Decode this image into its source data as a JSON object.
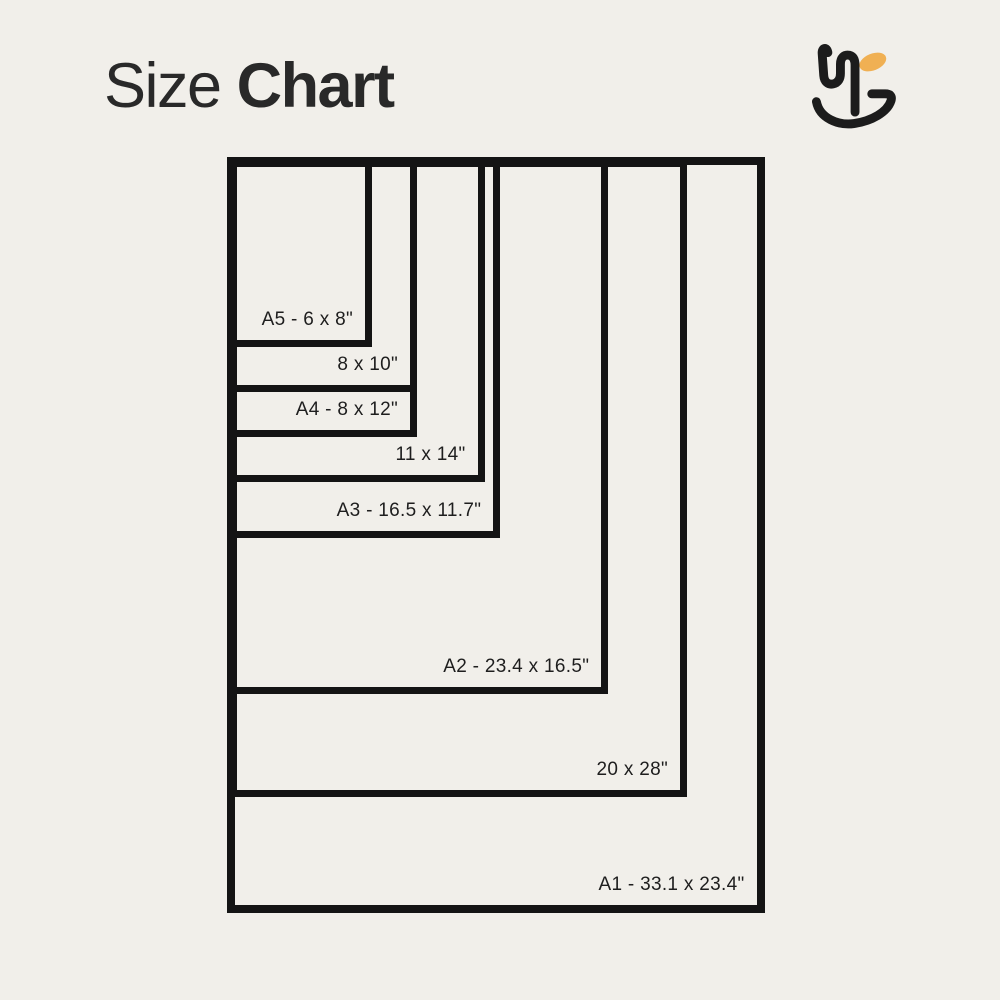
{
  "page": {
    "background_color": "#f1efea"
  },
  "header": {
    "title_regular": "Size",
    "title_bold": "Chart",
    "title_color": "#292929"
  },
  "logo": {
    "ink_color": "#1c1c1c",
    "accent_color": "#f0b053"
  },
  "chart": {
    "type": "nested-size-diagram",
    "units": "inches",
    "line_color": "#141414",
    "sizes": [
      {
        "name": "A1",
        "label": "A1 - 33.1 x 23.4\"",
        "width_in": 23.4,
        "height_in": 33.1
      },
      {
        "name": "20x28",
        "label": "20 x 28\"",
        "width_in": 20,
        "height_in": 28
      },
      {
        "name": "A2",
        "label": "A2 - 23.4 x 16.5\"",
        "width_in": 16.5,
        "height_in": 23.4
      },
      {
        "name": "A3",
        "label": "A3 - 16.5 x 11.7\"",
        "width_in": 11.7,
        "height_in": 16.5
      },
      {
        "name": "11x14",
        "label": "11 x 14\"",
        "width_in": 11,
        "height_in": 14
      },
      {
        "name": "A4",
        "label": "A4 - 8 x 12\"",
        "width_in": 8,
        "height_in": 12
      },
      {
        "name": "8x10",
        "label": "8 x 10\"",
        "width_in": 8,
        "height_in": 10
      },
      {
        "name": "A5",
        "label": "A5 - 6 x 8\"",
        "width_in": 6,
        "height_in": 8
      }
    ]
  }
}
